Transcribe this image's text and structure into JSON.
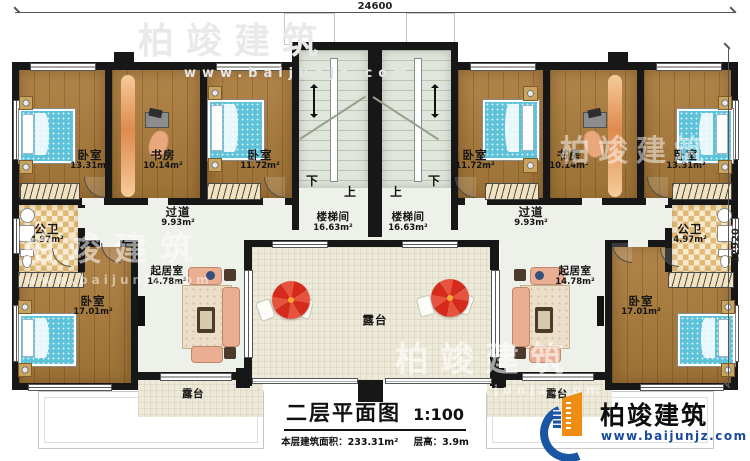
{
  "dimensions": {
    "top": "24600",
    "right": "12920"
  },
  "stair": {
    "down": "下",
    "up": "上"
  },
  "rooms": {
    "bedroom_tl": {
      "label": "卧室",
      "area": "13.31m²"
    },
    "study_l": {
      "label": "书房",
      "area": "10.14m²"
    },
    "bedroom_tcl": {
      "label": "卧室",
      "area": "11.72m²"
    },
    "stairwell_l": {
      "label": "楼梯间",
      "area": "16.63m²"
    },
    "stairwell_r": {
      "label": "楼梯间",
      "area": "16.63m²"
    },
    "bedroom_tcr": {
      "label": "卧室",
      "area": "11.72m²"
    },
    "study_r": {
      "label": "书房",
      "area": "10.14m²"
    },
    "bedroom_tr": {
      "label": "卧室",
      "area": "13.31m²"
    },
    "hallway_l": {
      "label": "过道",
      "area": "9.93m²"
    },
    "hallway_r": {
      "label": "过道",
      "area": "9.93m²"
    },
    "bath_l": {
      "label": "公卫",
      "area": "4.97m²"
    },
    "bath_r": {
      "label": "公卫",
      "area": "4.97m²"
    },
    "bedroom_bl": {
      "label": "卧室",
      "area": "17.01m²"
    },
    "bedroom_br": {
      "label": "卧室",
      "area": "17.01m²"
    },
    "living_l": {
      "label": "起居室",
      "area": "14.78m²"
    },
    "living_r": {
      "label": "起居室",
      "area": "14.78m²"
    },
    "terrace_c": {
      "label": "露台"
    },
    "terrace_bl": {
      "label": "露台"
    },
    "terrace_br": {
      "label": "露台"
    }
  },
  "titleblock": {
    "title": "二层平面图",
    "scale": "1:100",
    "area_label": "本层建筑面积：",
    "area_value": "233.31m²",
    "floor_height_label": "层高：",
    "floor_height_value": "3.9m"
  },
  "brand": {
    "name": "柏竣建筑",
    "website": "www.baijunjz.com"
  },
  "watermark": {
    "name": "柏竣建筑",
    "website": "www.baijunjz.com"
  },
  "colors": {
    "wall": "#171717",
    "wood_floor": "#a6793c",
    "bed_blue": "#5ec2d9",
    "umbrella_red": "#d62a1c",
    "brand_blue": "#1b56a4",
    "brand_orange": "#ef8d13",
    "terrace": "#edead9",
    "tile": "#e2ba74"
  }
}
